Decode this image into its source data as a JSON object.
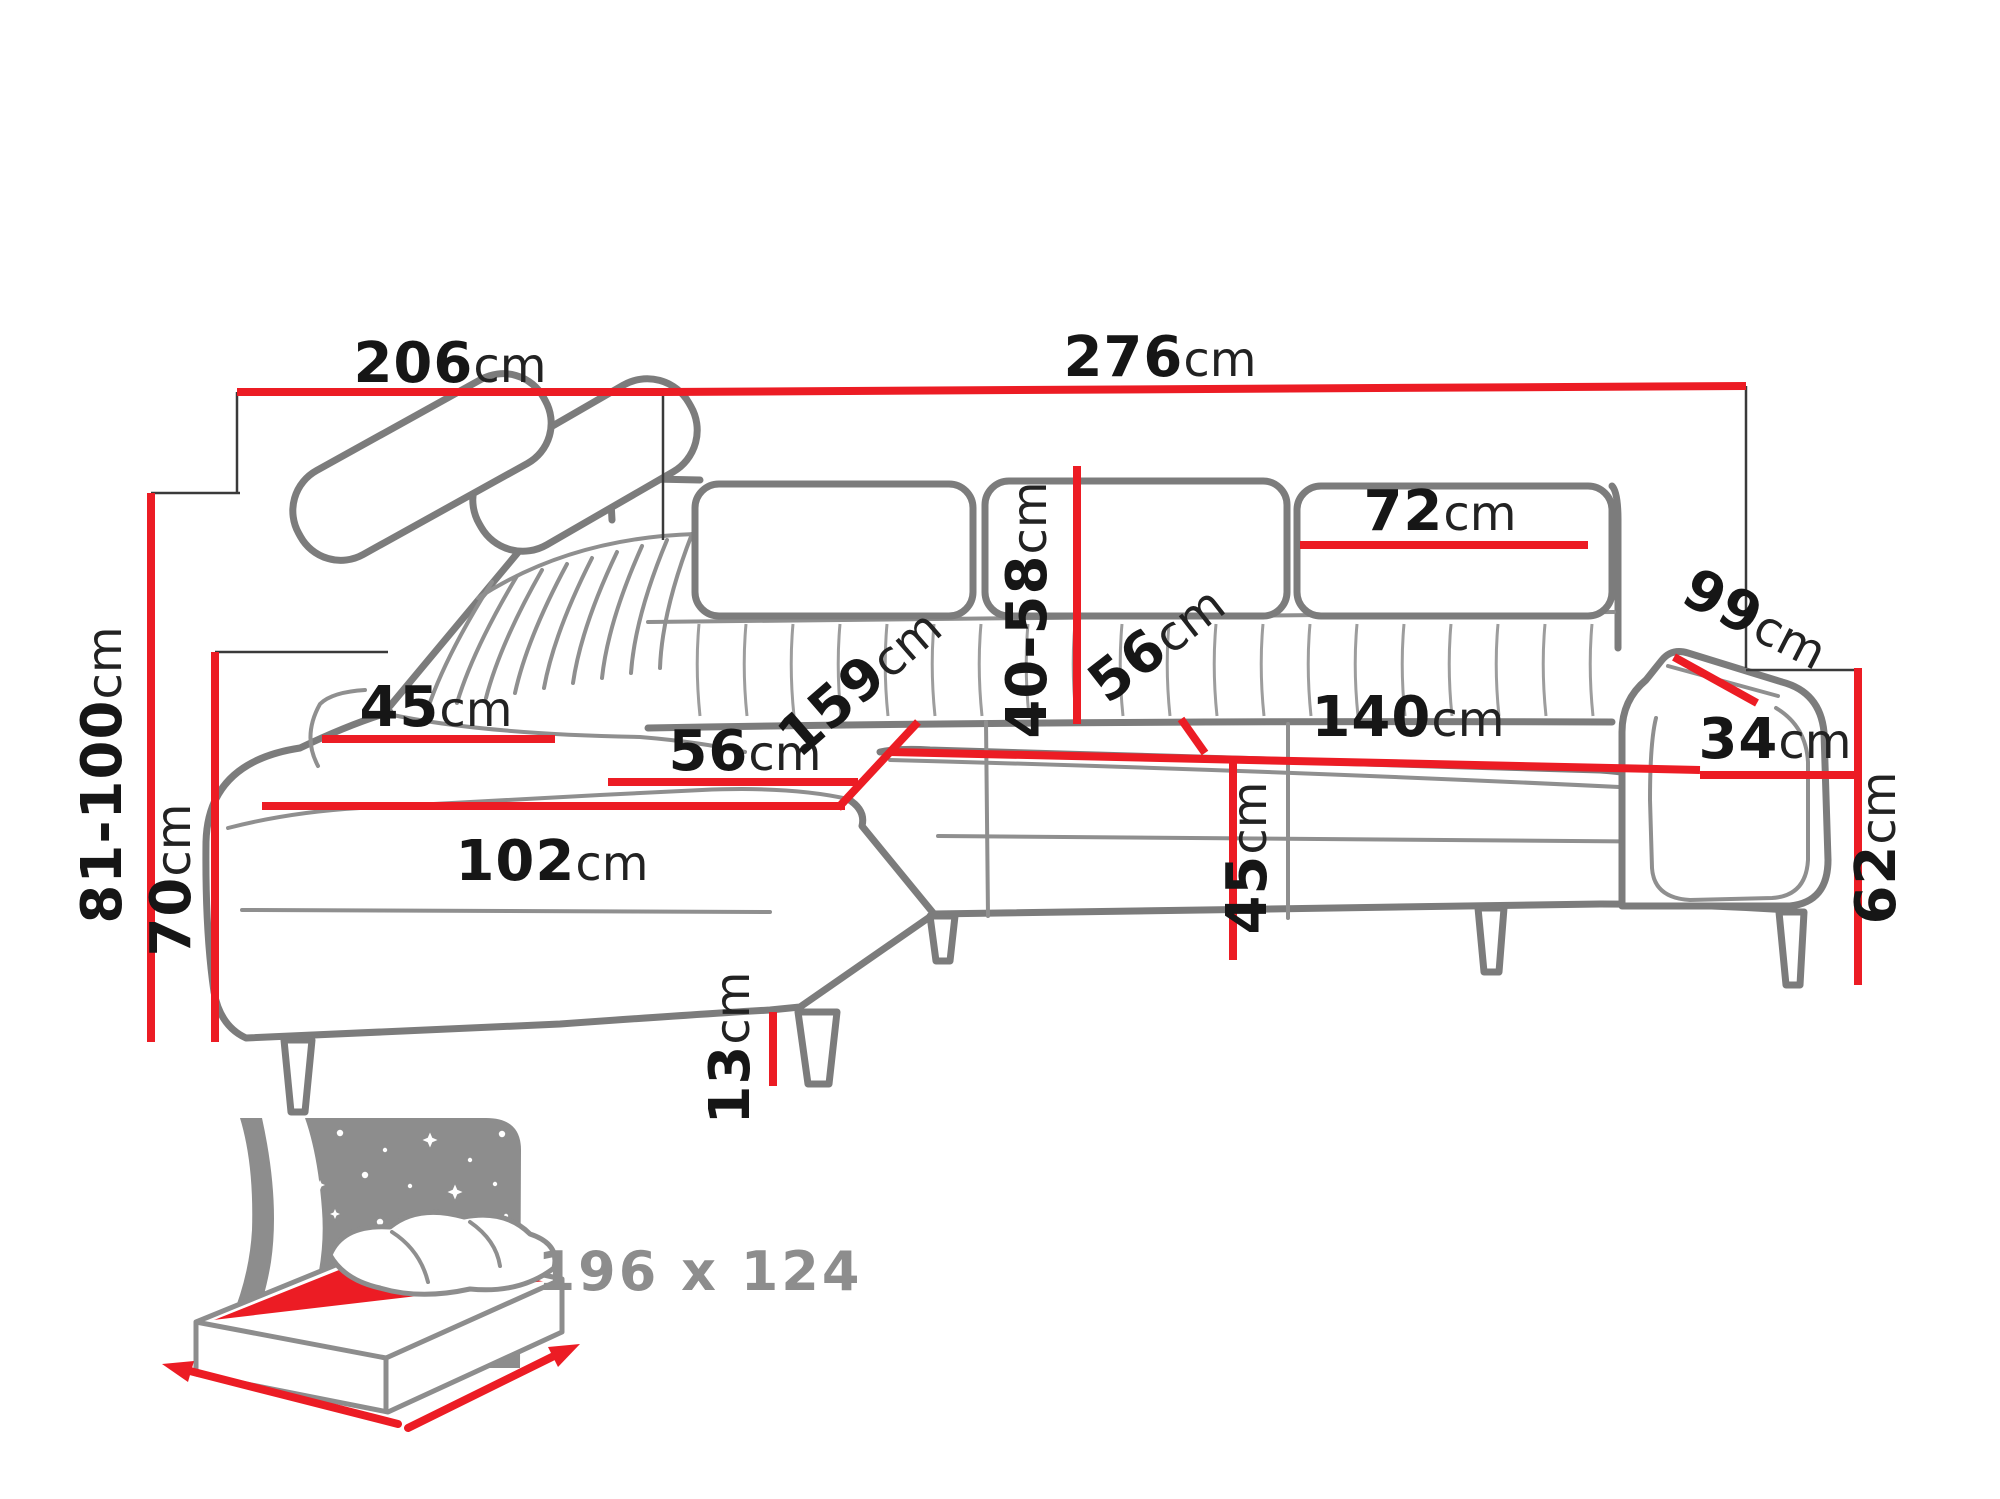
{
  "title": "Corner sofa dimensions diagram",
  "colors": {
    "dimension_red": "#ec1c24",
    "outline_gray": "#7c7c7c",
    "label_black": "#161616",
    "muted_gray": "#8d8d8d"
  },
  "dimensions": {
    "total_width_left": {
      "num": "206",
      "unit": "cm"
    },
    "total_width_right": {
      "num": "276",
      "unit": "cm"
    },
    "headrest_width": {
      "num": "72",
      "unit": "cm"
    },
    "armrest_depth": {
      "num": "99",
      "unit": "cm"
    },
    "adjustable_height": {
      "num": "81-100",
      "unit": "cm"
    },
    "left_arm_height": {
      "num": "70",
      "unit": "cm"
    },
    "back_cushion_width": {
      "num": "45",
      "unit": "cm"
    },
    "chaise_seat_depth": {
      "num": "56",
      "unit": "cm"
    },
    "chaise_diagonal": {
      "num": "159",
      "unit": "cm"
    },
    "backrest_height": {
      "num": "40-58",
      "unit": "cm"
    },
    "seat_depth": {
      "num": "56",
      "unit": "cm"
    },
    "seat_width": {
      "num": "140",
      "unit": "cm"
    },
    "armrest_width": {
      "num": "34",
      "unit": "cm"
    },
    "right_arm_height": {
      "num": "62",
      "unit": "cm"
    },
    "chaise_length": {
      "num": "102",
      "unit": "cm"
    },
    "seat_height": {
      "num": "45",
      "unit": "cm"
    },
    "leg_height": {
      "num": "13",
      "unit": "cm"
    }
  },
  "sleeping_area": {
    "label": "196 x 124"
  }
}
